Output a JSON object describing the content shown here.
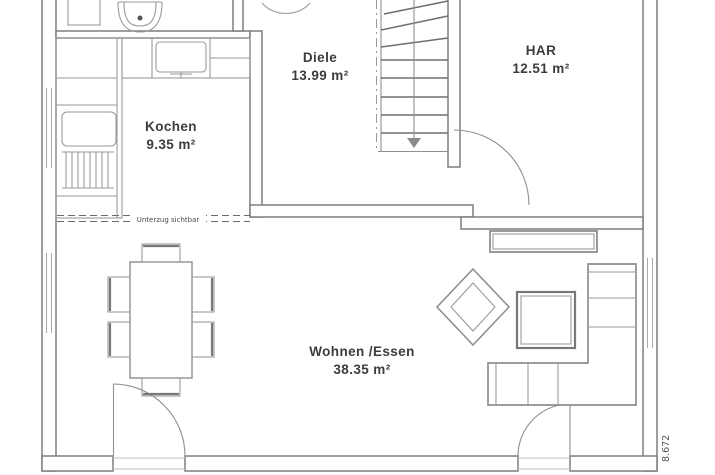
{
  "plan": {
    "rooms": [
      {
        "name": "Diele",
        "area": "13.99 m²"
      },
      {
        "name": "HAR",
        "area": "12.51 m²"
      },
      {
        "name": "Kochen",
        "area": "9.35 m²"
      },
      {
        "name": "Wohnen /Essen",
        "area": "38.35 m²"
      }
    ],
    "annotations": {
      "beam_note": "Unterzug sichtbar",
      "right_dimension": "8.672"
    },
    "colors": {
      "background": "#ffffff",
      "wall_line": "#7e7e7e",
      "furniture_line": "#8f8f8f",
      "text": "#3c3c3c"
    },
    "furniture": [
      "staircase",
      "washbasin",
      "kitchen-counter",
      "kitchen-sink",
      "kitchen-appliance",
      "radiator",
      "dining-table",
      "dining-chairs",
      "diamond-armchair",
      "coffee-table",
      "corner-sofa",
      "sideboard",
      "terrace-doors",
      "har-door"
    ]
  }
}
